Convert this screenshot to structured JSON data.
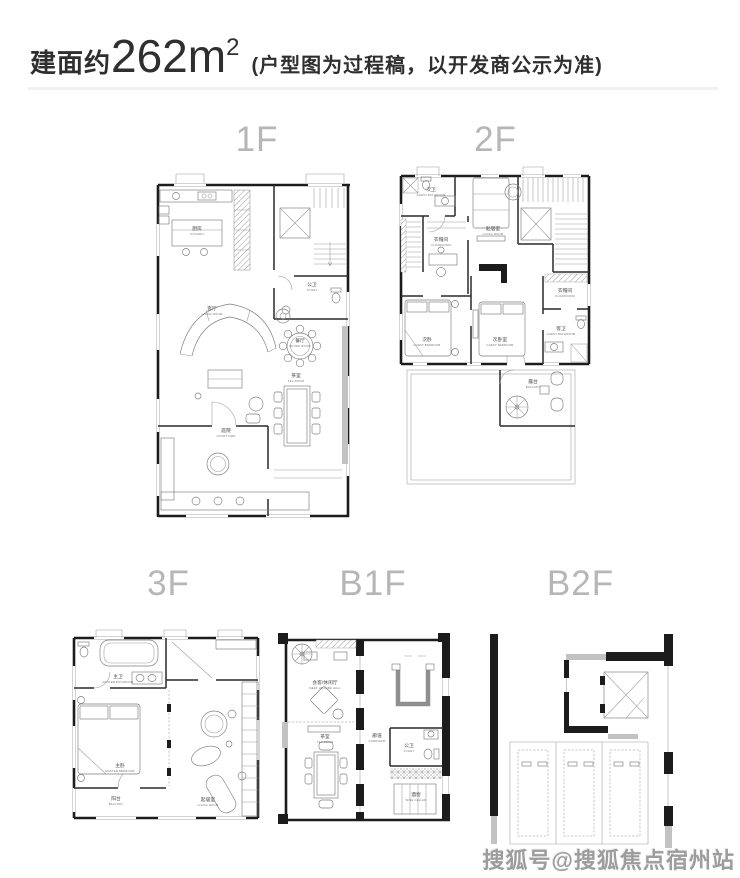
{
  "header": {
    "area_prefix": "建面约",
    "area_value": "262m",
    "area_sup": "2",
    "note": "(户型图为过程稿，以开发商公示为准)"
  },
  "floors": [
    {
      "label": "1F",
      "rooms": [
        {
          "zh": "厨房",
          "en": "KITCHEN"
        },
        {
          "zh": "公卫",
          "en": "TOILET"
        },
        {
          "zh": "客厅",
          "en": "LIVING ROOM"
        },
        {
          "zh": "餐厅",
          "en": "DINING ROOM"
        },
        {
          "zh": "茶室",
          "en": "TEA ROOM"
        },
        {
          "zh": "庭院",
          "en": "COURTYARD"
        }
      ]
    },
    {
      "label": "2F",
      "rooms": [
        {
          "zh": "次卫",
          "en": "GUEST BATHROOM"
        },
        {
          "zh": "起居室",
          "en": "LIVING ROOM"
        },
        {
          "zh": "衣帽间",
          "en": "CLOAKROOM"
        },
        {
          "zh": "次卧",
          "en": "GUEST BEDROOM"
        },
        {
          "zh": "次卧室",
          "en": "GUEST BEDROOM"
        },
        {
          "zh": "衣帽间",
          "en": "CLOAKROOM"
        },
        {
          "zh": "客卫",
          "en": "GUEST BATHROOM"
        },
        {
          "zh": "露台",
          "en": "BALCONY"
        }
      ]
    },
    {
      "label": "3F",
      "rooms": [
        {
          "zh": "主卫",
          "en": "MASTER BATHROOM"
        },
        {
          "zh": "主卧",
          "en": "MASTER BEDROOM"
        },
        {
          "zh": "阳台",
          "en": "BALCONY"
        },
        {
          "zh": "起居室",
          "en": "LIVING ROOM"
        }
      ]
    },
    {
      "label": "B1F",
      "rooms": [
        {
          "zh": "会客/休闲厅",
          "en": "MEET LEISURE HALL"
        },
        {
          "zh": "茶室",
          "en": "TEA ROOM"
        },
        {
          "zh": "廊道",
          "en": "CORRIDOR"
        },
        {
          "zh": "公卫",
          "en": "TOILET"
        },
        {
          "zh": "酒窖",
          "en": "WINE CELLAR"
        }
      ]
    },
    {
      "label": "B2F",
      "rooms": []
    }
  ],
  "watermark": "搜狐号@搜狐焦点宿州站"
}
